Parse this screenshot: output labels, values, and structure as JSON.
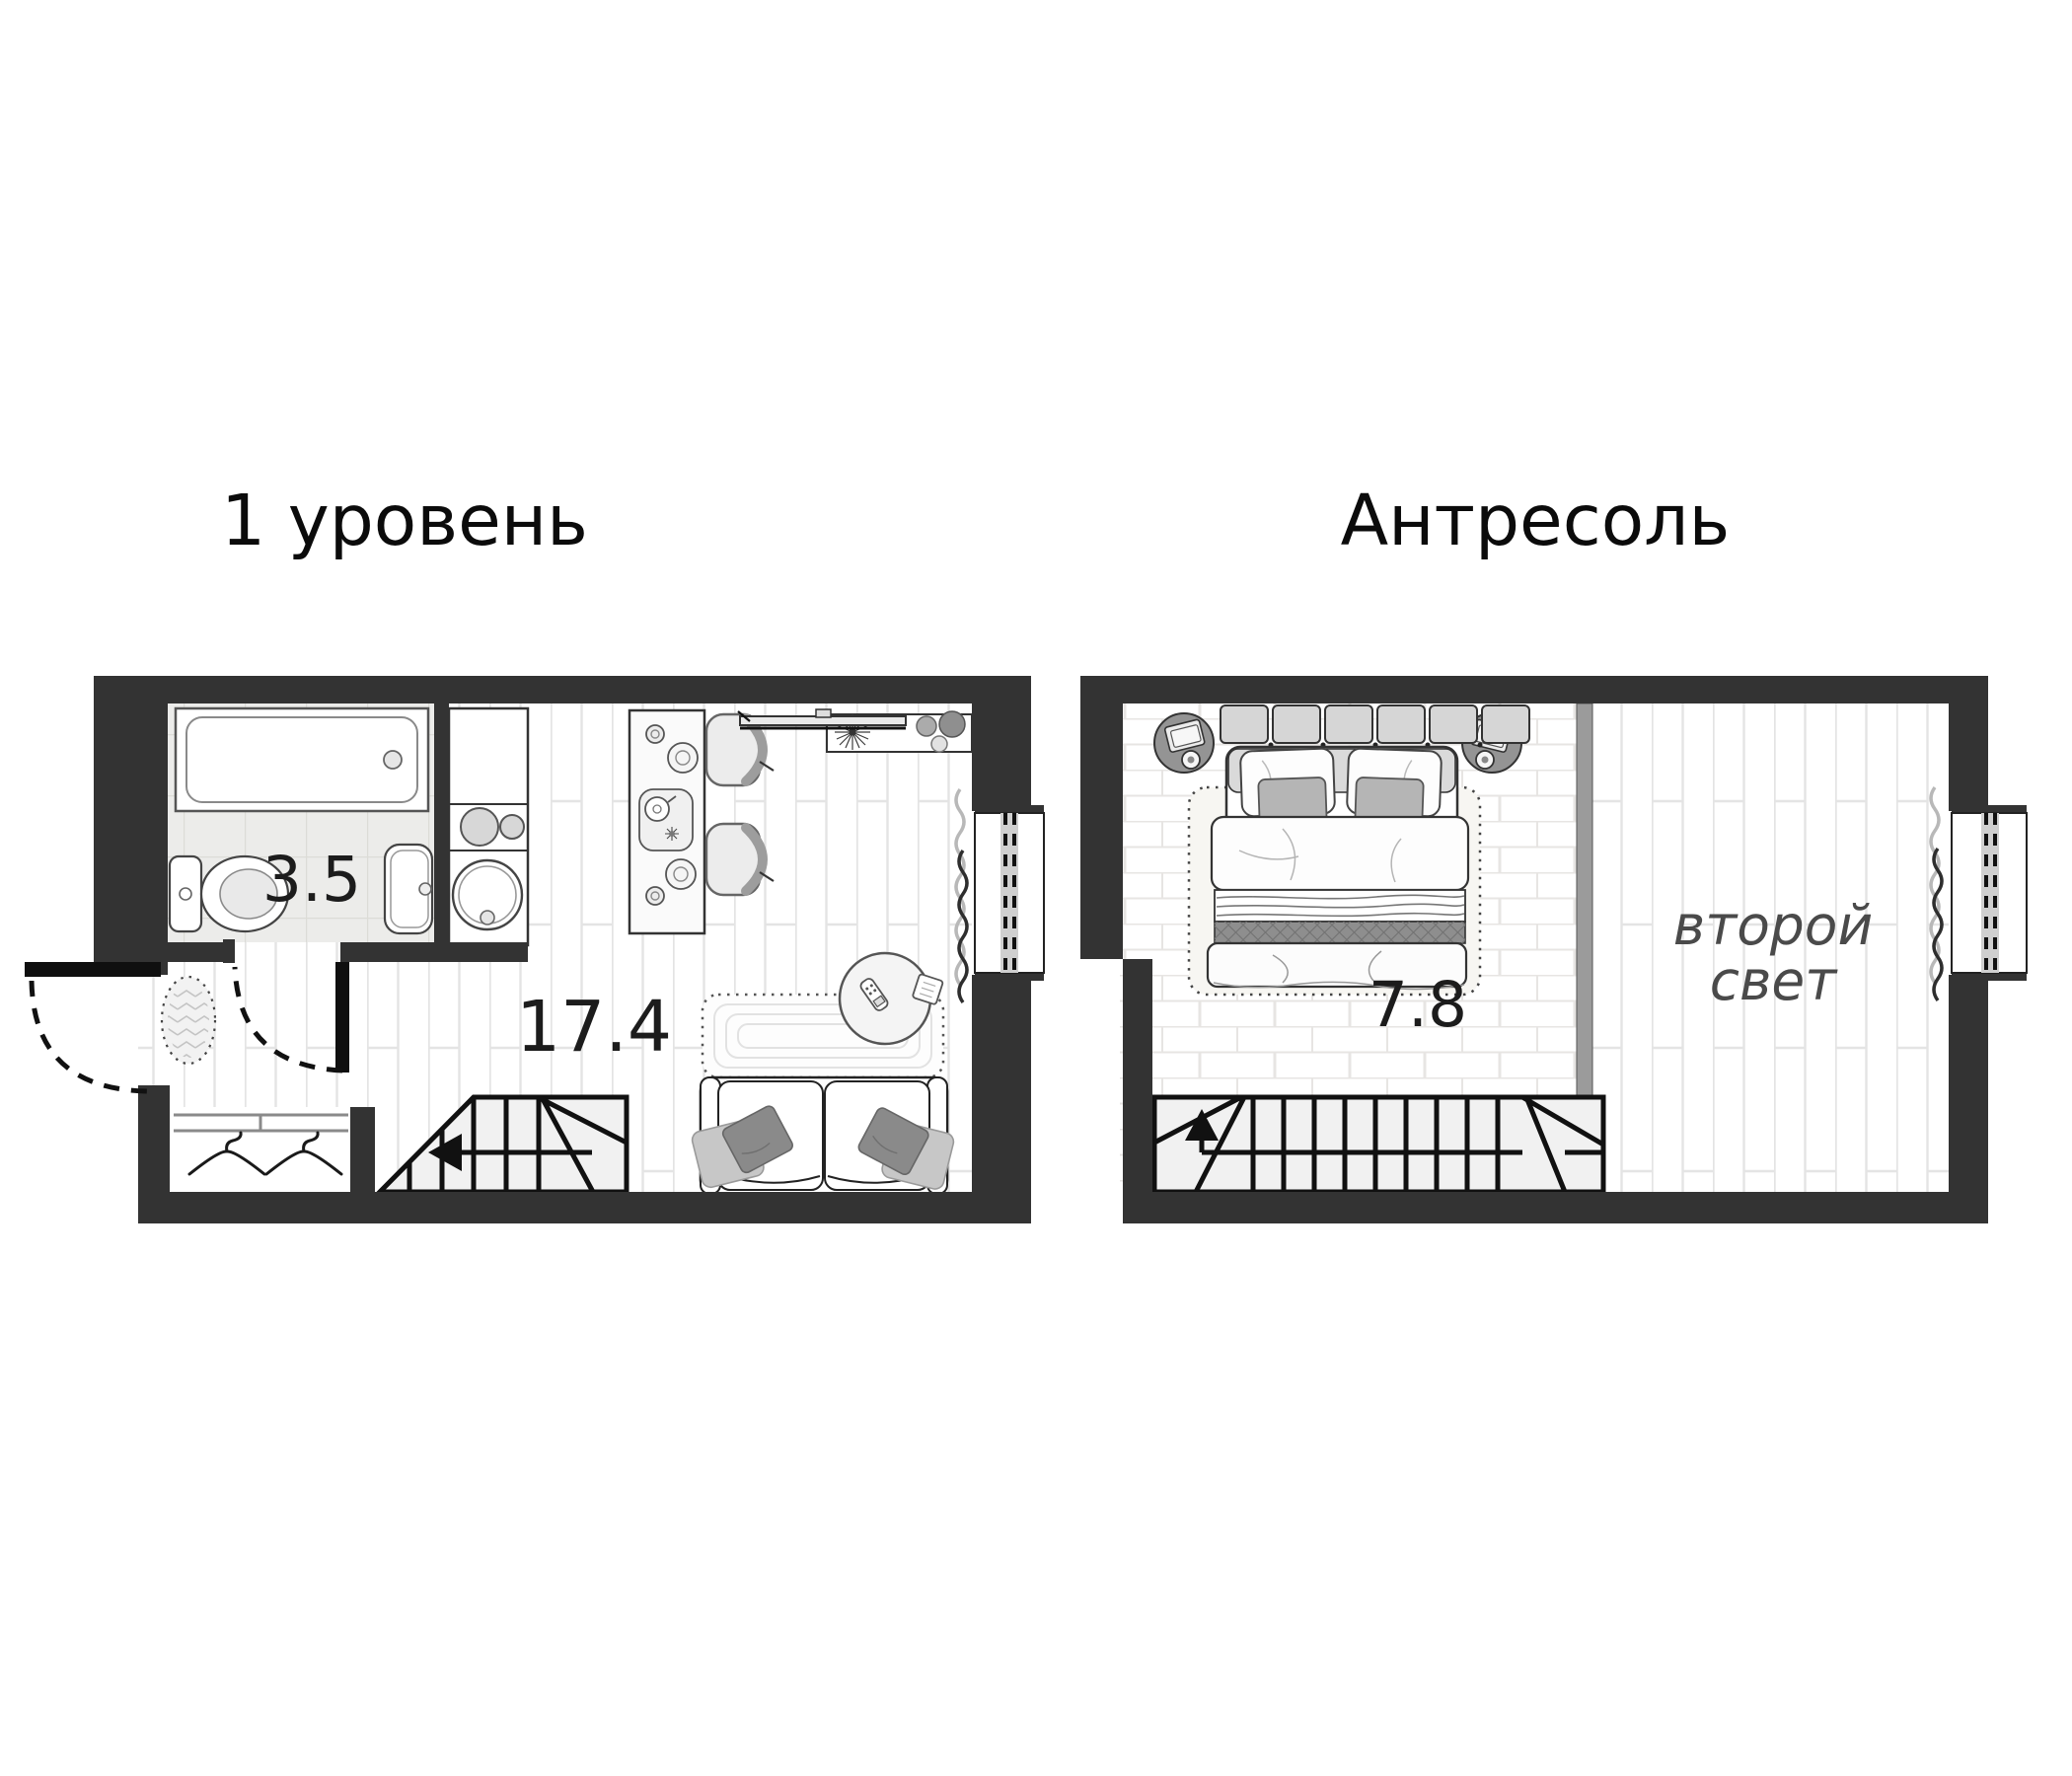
{
  "background": "#ffffff",
  "colors": {
    "wall": "#333333",
    "outline": "#111111",
    "stair_fill": "#f1f1f1",
    "bathroom_tile": "#ececea",
    "divider_gray": "#9b9b9b",
    "accent_pillow_gray": "#8a8a8a",
    "area_text": "#1c1c1c",
    "void_text": "#4a4a4a"
  },
  "plan1": {
    "title": "1 уровень",
    "bathroom_area": "3.5",
    "living_area": "17.4",
    "furniture": [
      "bathtub",
      "toilet",
      "washbasin",
      "kitchen-block",
      "cooktop",
      "kitchen-sink",
      "bar-island",
      "bar-stools",
      "tv",
      "console-shelf",
      "plant",
      "doormat",
      "wardrobe-hangers",
      "stairs-down",
      "sofa",
      "pillows",
      "carpet",
      "side-table",
      "remote-control",
      "window",
      "curtain",
      "entrance-door",
      "bathroom-door"
    ]
  },
  "plan2": {
    "title": "Антресоль",
    "bedroom_area": "7.8",
    "void_label_line1": "второй",
    "void_label_line2": "свет",
    "furniture": [
      "double-bed",
      "headboard",
      "pillows",
      "nightstands",
      "table-lamps",
      "books",
      "bedroom-rug",
      "glass-divider",
      "stairs-up",
      "window",
      "curtain"
    ]
  }
}
